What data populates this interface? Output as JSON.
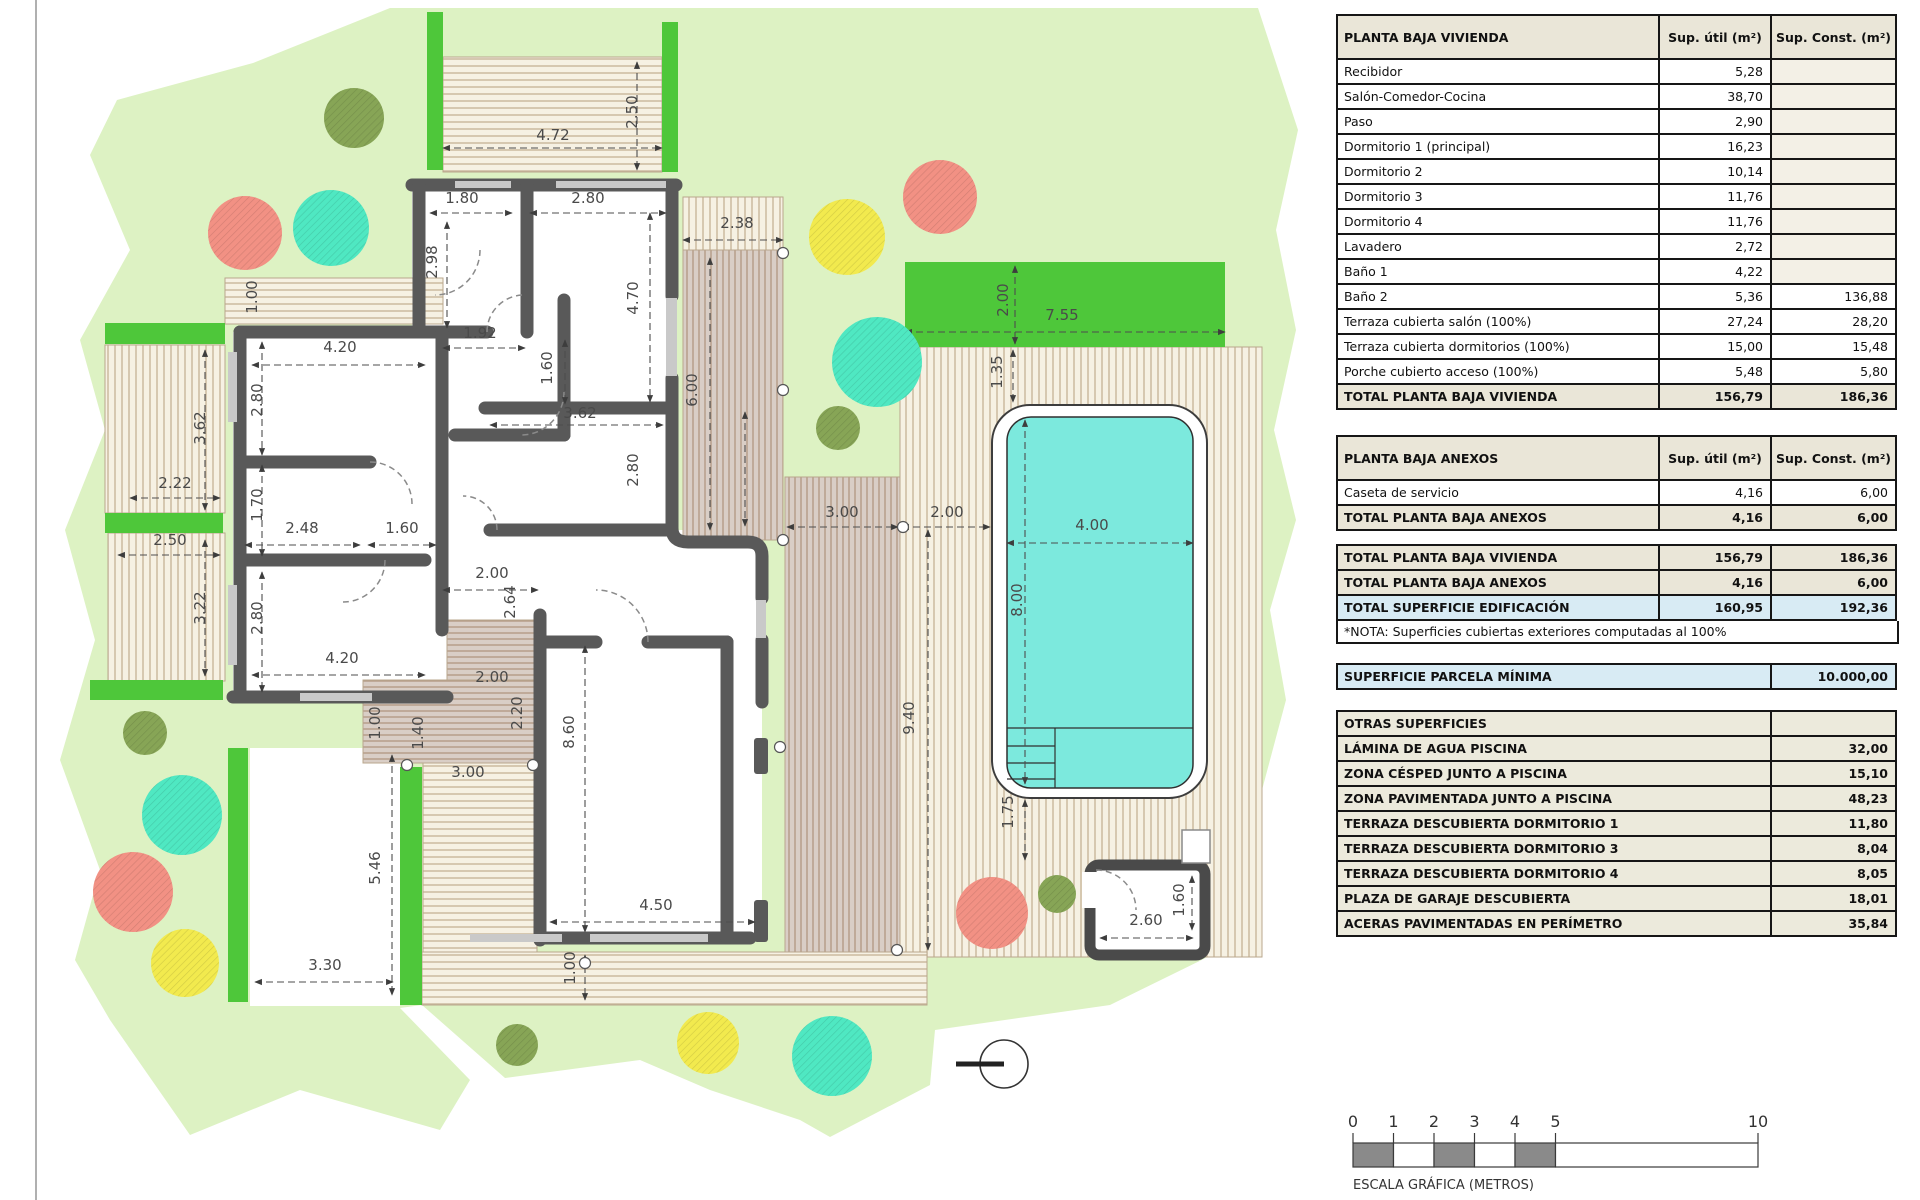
{
  "panel": {
    "col_headers": [
      "Sup. útil\n(m²)",
      "Sup. Const.\n(m²)"
    ],
    "planta_baja_vivienda": {
      "title": "PLANTA BAJA VIVIENDA",
      "rows": [
        [
          "Recibidor",
          "5,28",
          ""
        ],
        [
          "Salón-Comedor-Cocina",
          "38,70",
          ""
        ],
        [
          "Paso",
          "2,90",
          ""
        ],
        [
          "Dormitorio 1 (principal)",
          "16,23",
          ""
        ],
        [
          "Dormitorio 2",
          "10,14",
          ""
        ],
        [
          "Dormitorio 3",
          "11,76",
          ""
        ],
        [
          "Dormitorio 4",
          "11,76",
          ""
        ],
        [
          "Lavadero",
          "2,72",
          ""
        ],
        [
          "Baño 1",
          "4,22",
          ""
        ],
        [
          "Baño 2",
          "5,36",
          "136,88"
        ],
        [
          "Terraza cubierta salón (100%)",
          "27,24",
          "28,20"
        ],
        [
          "Terraza cubierta dormitorios (100%)",
          "15,00",
          "15,48"
        ],
        [
          "Porche cubierto acceso (100%)",
          "5,48",
          "5,80"
        ]
      ],
      "total": [
        "TOTAL PLANTA BAJA VIVIENDA",
        "156,79",
        "186,36"
      ]
    },
    "planta_baja_anexos": {
      "title": "PLANTA BAJA ANEXOS",
      "rows": [
        [
          "Caseta de servicio",
          "4,16",
          "6,00"
        ]
      ],
      "total": [
        "TOTAL PLANTA BAJA ANEXOS",
        "4,16",
        "6,00"
      ]
    },
    "totales": [
      [
        "TOTAL PLANTA BAJA VIVIENDA",
        "156,79",
        "186,36",
        "tot"
      ],
      [
        "TOTAL PLANTA BAJA ANEXOS",
        "4,16",
        "6,00",
        "tot"
      ],
      [
        "TOTAL SUPERFICIE EDIFICACIÓN",
        "160,95",
        "192,36",
        "tot blue"
      ]
    ],
    "nota": "*NOTA: Superficies cubiertas exteriores computadas al 100%",
    "parcela": [
      "SUPERFICIE PARCELA MÍNIMA",
      "10.000,00"
    ],
    "otras_superficies": {
      "title": "OTRAS SUPERFICIES",
      "rows": [
        [
          "LÁMINA DE AGUA PISCINA",
          "32,00"
        ],
        [
          "ZONA CÉSPED JUNTO A PISCINA",
          "15,10"
        ],
        [
          "ZONA PAVIMENTADA JUNTO A PISCINA",
          "48,23"
        ],
        [
          "TERRAZA DESCUBIERTA DORMITORIO 1",
          "11,80"
        ],
        [
          "TERRAZA DESCUBIERTA DORMITORIO 3",
          "8,04"
        ],
        [
          "TERRAZA DESCUBIERTA DORMITORIO 4",
          "8,05"
        ],
        [
          "PLAZA DE GARAJE DESCUBIERTA",
          "18,01"
        ],
        [
          "ACERAS PAVIMENTADAS EN PERÍMETRO",
          "35,84"
        ]
      ]
    }
  },
  "colors": {
    "parcel": "#ddf2c3",
    "hedge": "#4ec73a",
    "pool_water": "#7ce9dd",
    "wall": "#595959",
    "cream_bg": "#f6f1e3",
    "cream_line": "#c9b79b",
    "taupe_bg": "#d9cec6",
    "taupe_line": "#b49b86",
    "table_beige": "#eae6d8",
    "table_blue": "#d8ebf4",
    "scale_gray": "#8a8a8a",
    "dim_text": "#4a4a4a"
  },
  "plan": {
    "dimensions": [
      {
        "t": "2.50",
        "x": 637,
        "y": 112,
        "r": 1
      },
      {
        "t": "4.72",
        "x": 553,
        "y": 140,
        "r": 0
      },
      {
        "t": "1.80",
        "x": 462,
        "y": 203,
        "r": 0
      },
      {
        "t": "2.80",
        "x": 588,
        "y": 203,
        "r": 0
      },
      {
        "t": "2.38",
        "x": 737,
        "y": 228,
        "r": 0
      },
      {
        "t": "2.98",
        "x": 437,
        "y": 262,
        "r": 1
      },
      {
        "t": "4.70",
        "x": 638,
        "y": 298,
        "r": 1
      },
      {
        "t": "1.00",
        "x": 257,
        "y": 297,
        "r": 1
      },
      {
        "t": "1.92",
        "x": 480,
        "y": 338,
        "r": 0
      },
      {
        "t": "4.20",
        "x": 340,
        "y": 352,
        "r": 0
      },
      {
        "t": "1.60",
        "x": 552,
        "y": 368,
        "r": 1
      },
      {
        "t": "6.00",
        "x": 697,
        "y": 390,
        "r": 1
      },
      {
        "t": "2.80",
        "x": 262,
        "y": 400,
        "r": 1
      },
      {
        "t": "3.62",
        "x": 580,
        "y": 418,
        "r": 0
      },
      {
        "t": "3.62",
        "x": 205,
        "y": 428,
        "r": 1
      },
      {
        "t": "2.80",
        "x": 638,
        "y": 470,
        "r": 1
      },
      {
        "t": "2.22",
        "x": 175,
        "y": 488,
        "r": 0
      },
      {
        "t": "1.70",
        "x": 262,
        "y": 505,
        "r": 1
      },
      {
        "t": "2.48",
        "x": 302,
        "y": 533,
        "r": 0
      },
      {
        "t": "1.60",
        "x": 402,
        "y": 533,
        "r": 0
      },
      {
        "t": "2.50",
        "x": 170,
        "y": 545,
        "r": 0
      },
      {
        "t": "2.00",
        "x": 492,
        "y": 578,
        "r": 0
      },
      {
        "t": "2.64",
        "x": 515,
        "y": 602,
        "r": 1
      },
      {
        "t": "3.22",
        "x": 205,
        "y": 608,
        "r": 1
      },
      {
        "t": "2.80",
        "x": 262,
        "y": 618,
        "r": 1
      },
      {
        "t": "4.20",
        "x": 342,
        "y": 663,
        "r": 0
      },
      {
        "t": "2.00",
        "x": 492,
        "y": 682,
        "r": 0
      },
      {
        "t": "1.00",
        "x": 380,
        "y": 723,
        "r": 1
      },
      {
        "t": "1.40",
        "x": 423,
        "y": 733,
        "r": 1
      },
      {
        "t": "2.20",
        "x": 522,
        "y": 713,
        "r": 1
      },
      {
        "t": "8.60",
        "x": 574,
        "y": 732,
        "r": 1
      },
      {
        "t": "3.00",
        "x": 468,
        "y": 777,
        "r": 0
      },
      {
        "t": "5.46",
        "x": 380,
        "y": 868,
        "r": 1
      },
      {
        "t": "4.50",
        "x": 656,
        "y": 910,
        "r": 0
      },
      {
        "t": "3.30",
        "x": 325,
        "y": 970,
        "r": 0
      },
      {
        "t": "1.00",
        "x": 575,
        "y": 968,
        "r": 1
      },
      {
        "t": "3.00",
        "x": 842,
        "y": 517,
        "r": 0
      },
      {
        "t": "2.00",
        "x": 947,
        "y": 517,
        "r": 0
      },
      {
        "t": "4.00",
        "x": 1092,
        "y": 530,
        "r": 0
      },
      {
        "t": "9.40",
        "x": 914,
        "y": 718,
        "r": 1
      },
      {
        "t": "1.35",
        "x": 1002,
        "y": 372,
        "r": 1
      },
      {
        "t": "2.00",
        "x": 1008,
        "y": 300,
        "r": 1
      },
      {
        "t": "7.55",
        "x": 1062,
        "y": 320,
        "r": 0
      },
      {
        "t": "8.00",
        "x": 1022,
        "y": 600,
        "r": 1
      },
      {
        "t": "1.75",
        "x": 1013,
        "y": 812,
        "r": 1
      },
      {
        "t": "2.60",
        "x": 1146,
        "y": 925,
        "r": 0
      },
      {
        "t": "1.60",
        "x": 1184,
        "y": 900,
        "r": 1
      }
    ],
    "guide_lines": [
      [
        443,
        148,
        662,
        148
      ],
      [
        637,
        62,
        637,
        170
      ],
      [
        430,
        213,
        512,
        213
      ],
      [
        530,
        213,
        666,
        213
      ],
      [
        683,
        240,
        783,
        240
      ],
      [
        252,
        365,
        425,
        365
      ],
      [
        490,
        425,
        663,
        425
      ],
      [
        443,
        348,
        525,
        348
      ],
      [
        447,
        222,
        447,
        328
      ],
      [
        650,
        213,
        650,
        402
      ],
      [
        565,
        340,
        565,
        404
      ],
      [
        710,
        258,
        710,
        530
      ],
      [
        262,
        342,
        262,
        455
      ],
      [
        205,
        350,
        205,
        510
      ],
      [
        130,
        498,
        220,
        498
      ],
      [
        262,
        465,
        262,
        556
      ],
      [
        245,
        545,
        360,
        545
      ],
      [
        368,
        545,
        436,
        545
      ],
      [
        118,
        555,
        220,
        555
      ],
      [
        205,
        540,
        205,
        676
      ],
      [
        262,
        572,
        262,
        692
      ],
      [
        252,
        675,
        425,
        675
      ],
      [
        443,
        590,
        538,
        590
      ],
      [
        585,
        646,
        585,
        932
      ],
      [
        745,
        412,
        745,
        526
      ],
      [
        550,
        922,
        755,
        922
      ],
      [
        392,
        755,
        392,
        995
      ],
      [
        255,
        982,
        393,
        982
      ],
      [
        585,
        955,
        585,
        1000
      ],
      [
        905,
        332,
        1225,
        332
      ],
      [
        1015,
        266,
        1015,
        344
      ],
      [
        1007,
        543,
        1193,
        543
      ],
      [
        1025,
        420,
        1025,
        784
      ],
      [
        928,
        530,
        928,
        950
      ],
      [
        787,
        527,
        898,
        527
      ],
      [
        902,
        527,
        990,
        527
      ],
      [
        1025,
        800,
        1025,
        860
      ],
      [
        1013,
        350,
        1013,
        402
      ],
      [
        1100,
        938,
        1193,
        938
      ],
      [
        1192,
        876,
        1192,
        930
      ]
    ],
    "trees": [
      {
        "x": 354,
        "y": 118,
        "rad": 30,
        "c": "olive"
      },
      {
        "x": 838,
        "y": 428,
        "rad": 22,
        "c": "olive"
      },
      {
        "x": 145,
        "y": 733,
        "rad": 22,
        "c": "olive"
      },
      {
        "x": 1057,
        "y": 894,
        "rad": 19,
        "c": "olive"
      },
      {
        "x": 517,
        "y": 1045,
        "rad": 21,
        "c": "olive"
      },
      {
        "x": 245,
        "y": 233,
        "rad": 37,
        "c": "coral"
      },
      {
        "x": 940,
        "y": 197,
        "rad": 37,
        "c": "coral"
      },
      {
        "x": 133,
        "y": 892,
        "rad": 40,
        "c": "coral"
      },
      {
        "x": 992,
        "y": 913,
        "rad": 36,
        "c": "coral"
      },
      {
        "x": 331,
        "y": 228,
        "rad": 38,
        "c": "turquoise"
      },
      {
        "x": 877,
        "y": 362,
        "rad": 45,
        "c": "turquoise"
      },
      {
        "x": 182,
        "y": 815,
        "rad": 40,
        "c": "turquoise"
      },
      {
        "x": 832,
        "y": 1056,
        "rad": 40,
        "c": "turquoise"
      },
      {
        "x": 847,
        "y": 237,
        "rad": 38,
        "c": "yellow"
      },
      {
        "x": 185,
        "y": 963,
        "rad": 34,
        "c": "yellow"
      },
      {
        "x": 708,
        "y": 1043,
        "rad": 31,
        "c": "yellow"
      }
    ],
    "tree_colors": {
      "olive": "#87a556",
      "coral": "#f29184",
      "turquoise": "#4fe8c2",
      "yellow": "#f2ea4e"
    },
    "hedges": [
      [
        427,
        12,
        16,
        158
      ],
      [
        662,
        22,
        16,
        150
      ],
      [
        105,
        323,
        120,
        21
      ],
      [
        105,
        513,
        118,
        20
      ],
      [
        90,
        680,
        133,
        20
      ],
      [
        228,
        748,
        20,
        254
      ],
      [
        400,
        767,
        22,
        238
      ],
      [
        905,
        262,
        320,
        85
      ]
    ],
    "survey_points": [
      [
        783,
        253
      ],
      [
        783,
        390
      ],
      [
        783,
        540
      ],
      [
        903,
        527
      ],
      [
        407,
        765
      ],
      [
        533,
        765
      ],
      [
        780,
        747
      ],
      [
        897,
        950
      ],
      [
        585,
        963
      ]
    ],
    "compass": {
      "x": 1004,
      "y": 1064,
      "rad": 24
    },
    "scale_bar": {
      "x": 1353,
      "y": 1143,
      "h": 24,
      "px_per_m": 40.5,
      "labels": [
        0,
        1,
        2,
        3,
        4,
        5,
        10
      ],
      "segments": [
        [
          0,
          1,
          1
        ],
        [
          1,
          2,
          0
        ],
        [
          2,
          3,
          1
        ],
        [
          3,
          4,
          0
        ],
        [
          4,
          5,
          1
        ],
        [
          5,
          10,
          0
        ]
      ],
      "caption": "ESCALA GRÁFICA (METROS)"
    }
  }
}
